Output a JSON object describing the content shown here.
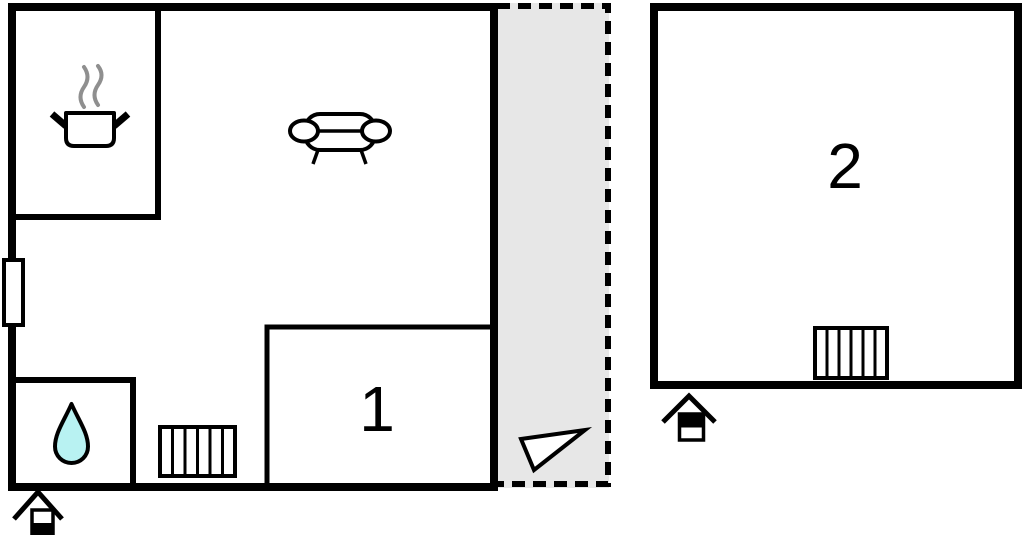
{
  "plan": {
    "rooms": [
      {
        "id": "room-1",
        "label": "1"
      },
      {
        "id": "room-2",
        "label": "2"
      }
    ],
    "colors": {
      "background": "#ffffff",
      "wall": "#000000",
      "terrace_fill": "#e7e7e7",
      "water_drop_fill": "#b8f2f2",
      "steam": "#8f8f8f"
    },
    "icons": [
      "cooking-pot-icon",
      "steam-icon",
      "sofa-icon",
      "window-icon",
      "water-drop-icon",
      "radiator-icon",
      "north-arrow-icon",
      "house-ground-floor-icon",
      "house-upper-floor-icon"
    ]
  }
}
